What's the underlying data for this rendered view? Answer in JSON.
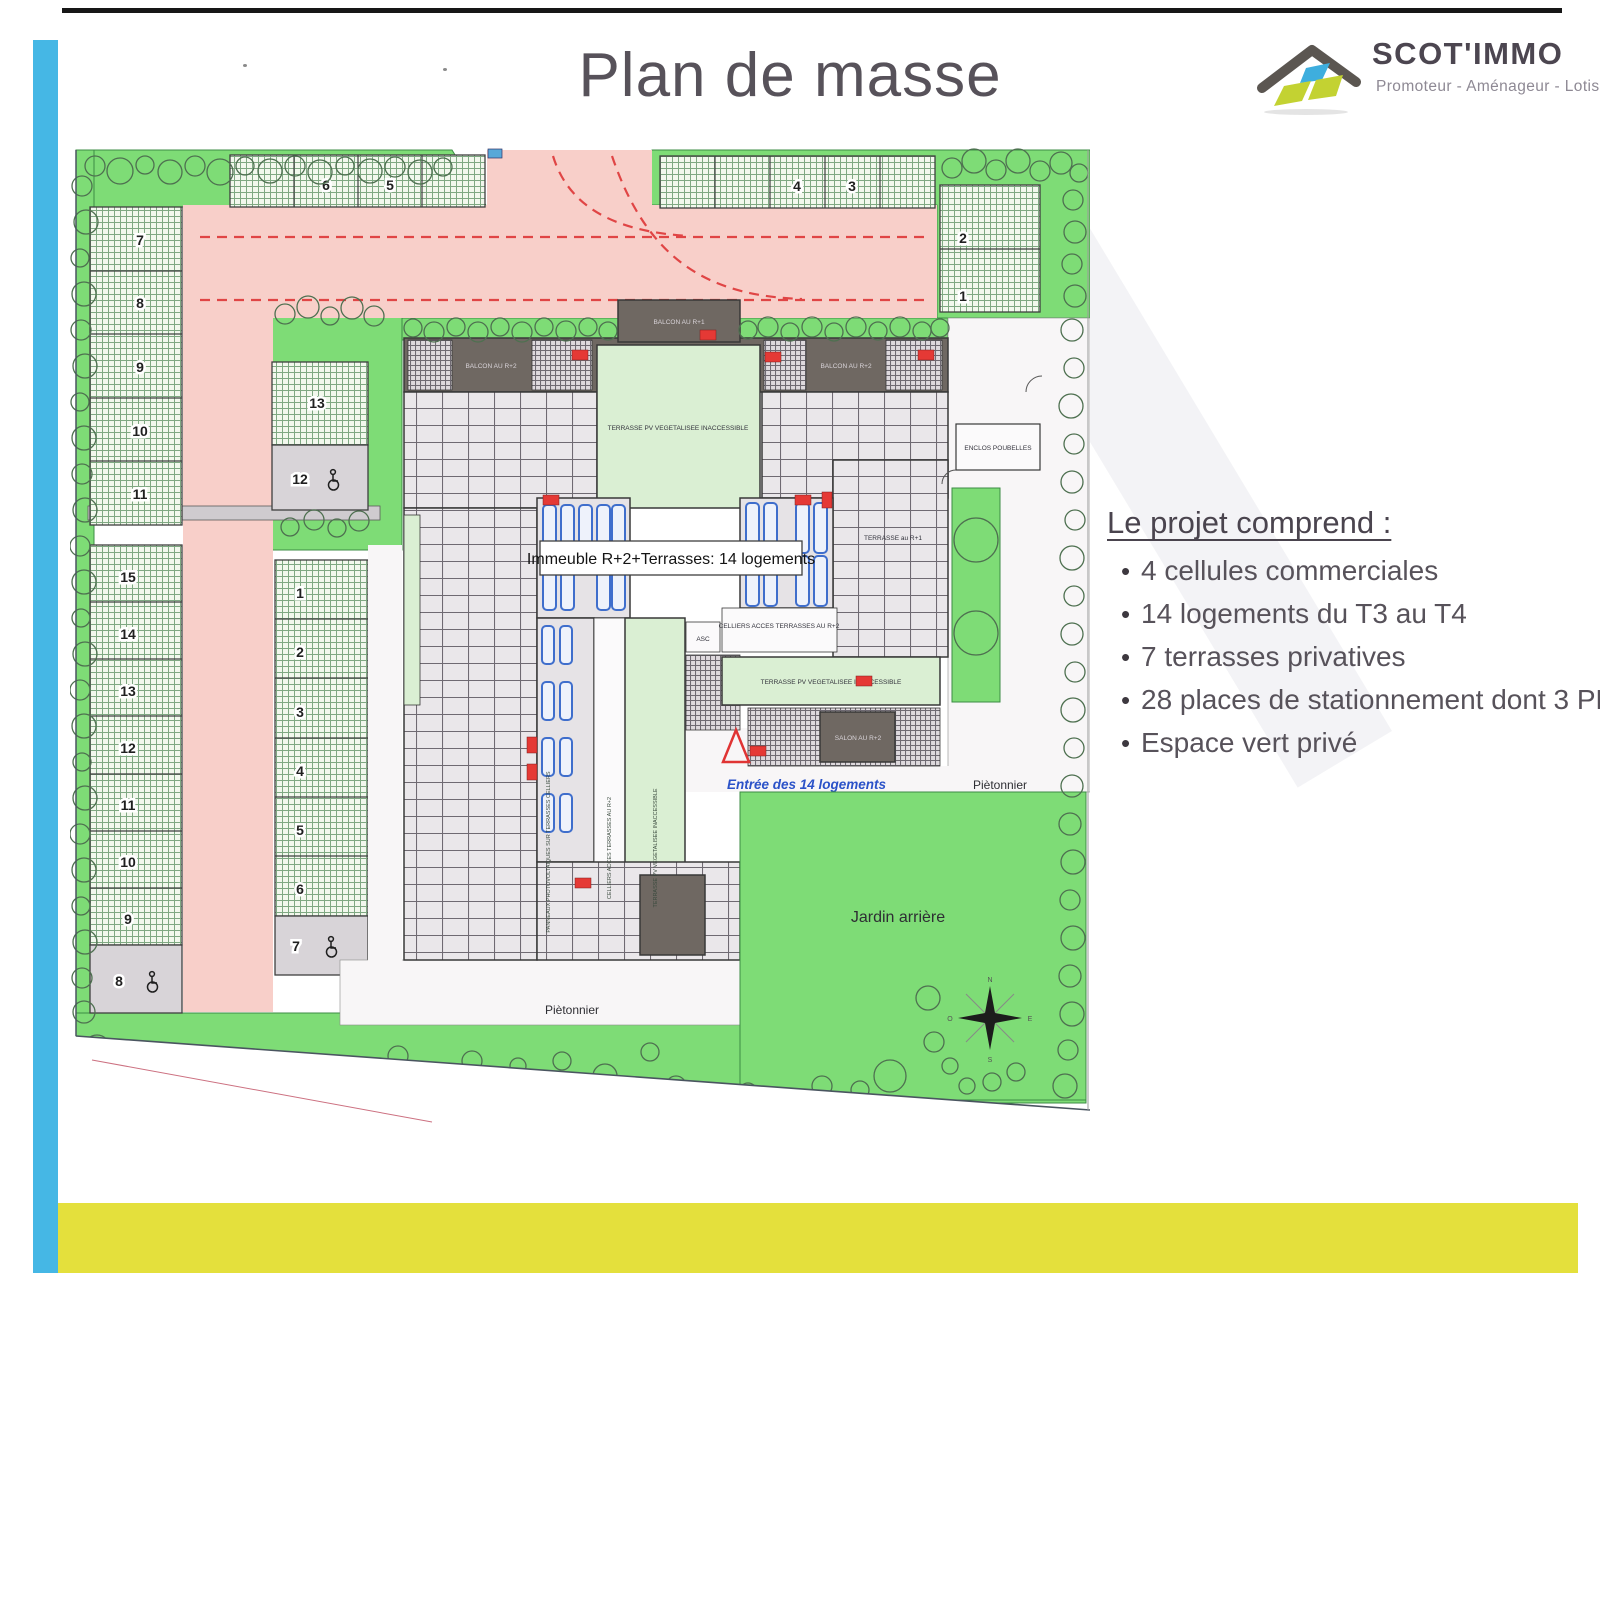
{
  "page": {
    "title": "Plan de masse"
  },
  "logo": {
    "name": "SCOT'IMMO",
    "tagline": "Promoteur - Aménageur - Lotisseur"
  },
  "project": {
    "heading": "Le projet comprend :",
    "bullets": [
      "4 cellules commerciales",
      "14 logements du T3 au T4",
      "7 terrasses privatives",
      "28 places de stationnement dont 3 PMR",
      "Espace vert privé"
    ]
  },
  "plan": {
    "labels": {
      "building": "Immeuble R+2+Terrasses: 14 logements",
      "entrance": "Entrée des 14 logements",
      "walkway_bottom": "Piètonnier",
      "walkway_right": "Piètonnier",
      "garden": "Jardin arrière",
      "bins": "ENCLOS POUBELLES",
      "elevator": "ASC",
      "balcon_r2_left": "BALCON AU R+2",
      "balcon_r2_right": "BALCON AU R+2",
      "balcon_r1": "BALCON AU R+1",
      "terrasse_pv_center": "TERRASSE PV VEGETALISEE INACCESSIBLE",
      "terrasse_pv_mid": "TERRASSE PV VEGETALISEE INACCESSIBLE",
      "terrasse_pv_vert": "TERRASSE PV VEGETALISEE INACCESSIBLE",
      "celliers": "CELLIERS ACCES TERRASSES AU R+2",
      "celliers_vert": "CELLIERS ACCES TERRASSES AU R+2",
      "panneaux_vert": "PANNEAUX PHOTOVOLTAIQUES SUR TERRASSES CELLIERS",
      "terrasse_r1": "TERRASSE au R+1",
      "salon_r2": "SALON AU R+2"
    },
    "compass": {
      "n": "N",
      "s": "S",
      "e": "E",
      "o": "O"
    },
    "parking": {
      "top_left": [
        "6",
        "5"
      ],
      "top_right": [
        "4",
        "3"
      ],
      "right_col": [
        "2",
        "1"
      ],
      "left_upper": [
        "7",
        "8",
        "9",
        "10",
        "11"
      ],
      "mid_upper": [
        "13",
        "12"
      ],
      "left_lower": [
        "15",
        "14",
        "13",
        "12",
        "11",
        "10",
        "9"
      ],
      "left_lower_pmr": "8",
      "mid_lower": [
        "1",
        "2",
        "3",
        "4",
        "5",
        "6"
      ],
      "mid_lower_pmr": "7"
    }
  }
}
